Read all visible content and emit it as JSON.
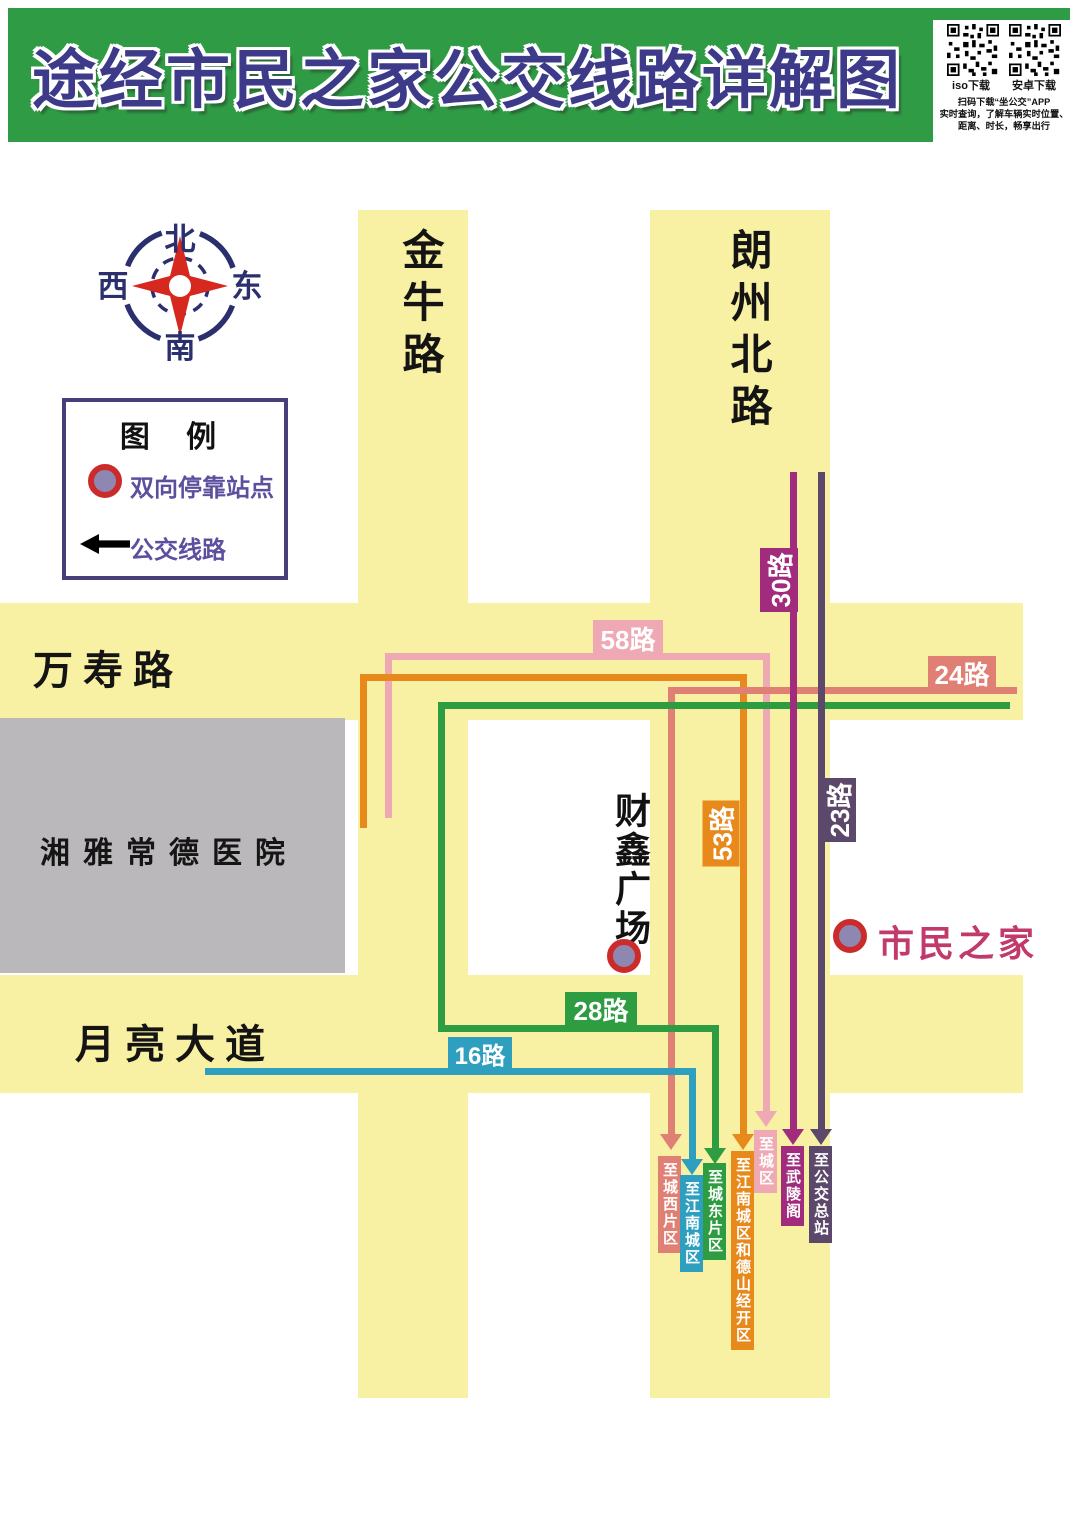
{
  "header": {
    "title": "途经市民之家公交线路详解图",
    "qr": {
      "left_label": "iso下载",
      "right_label": "安卓下载",
      "line1": "扫码下载“坐公交”APP",
      "line2": "实时查询，了解车辆实时位置、",
      "line3": "距离、时长，畅享出行"
    }
  },
  "compass": {
    "north": "北",
    "south": "南",
    "west": "西",
    "east": "东"
  },
  "legend": {
    "title": "图 例",
    "stop_label": "双向停靠站点",
    "route_label": "公交线路"
  },
  "roads": {
    "jinniu": "金牛路",
    "langzhou": "朗州北路",
    "wanshou": "万寿路",
    "yueliang": "月亮大道"
  },
  "places": {
    "hospital": "湘雅常德医院",
    "caixin": "财鑫广场",
    "shimin": "市民之家"
  },
  "colors": {
    "road_yellow": "#F8F0A2",
    "header_green": "#2F9B45",
    "title_purple": "#3E3A8A",
    "hospital_gray": "#BAB8BA",
    "stop_ring_red": "#CC2B2B",
    "stop_fill_purple": "#8E87B2"
  },
  "routes": {
    "r58": {
      "label": "58路",
      "dest": "至城区",
      "color": "#EFA9B4"
    },
    "r53": {
      "label": "53路",
      "dest": "至江南城区和德山经开区",
      "color": "#E8891C"
    },
    "r24": {
      "label": "24路",
      "dest": "至城西片区",
      "color": "#E07F73"
    },
    "r28": {
      "label": "28路",
      "dest": "至城东片区",
      "color": "#2E9C40"
    },
    "r16": {
      "label": "16路",
      "dest": "至江南城区",
      "color": "#2F9FC0"
    },
    "r30": {
      "label": "30路",
      "dest": "至武陵阁",
      "color": "#A12C7D"
    },
    "r23": {
      "label": "23路",
      "dest": "至公交总站",
      "color": "#5C486B"
    }
  }
}
